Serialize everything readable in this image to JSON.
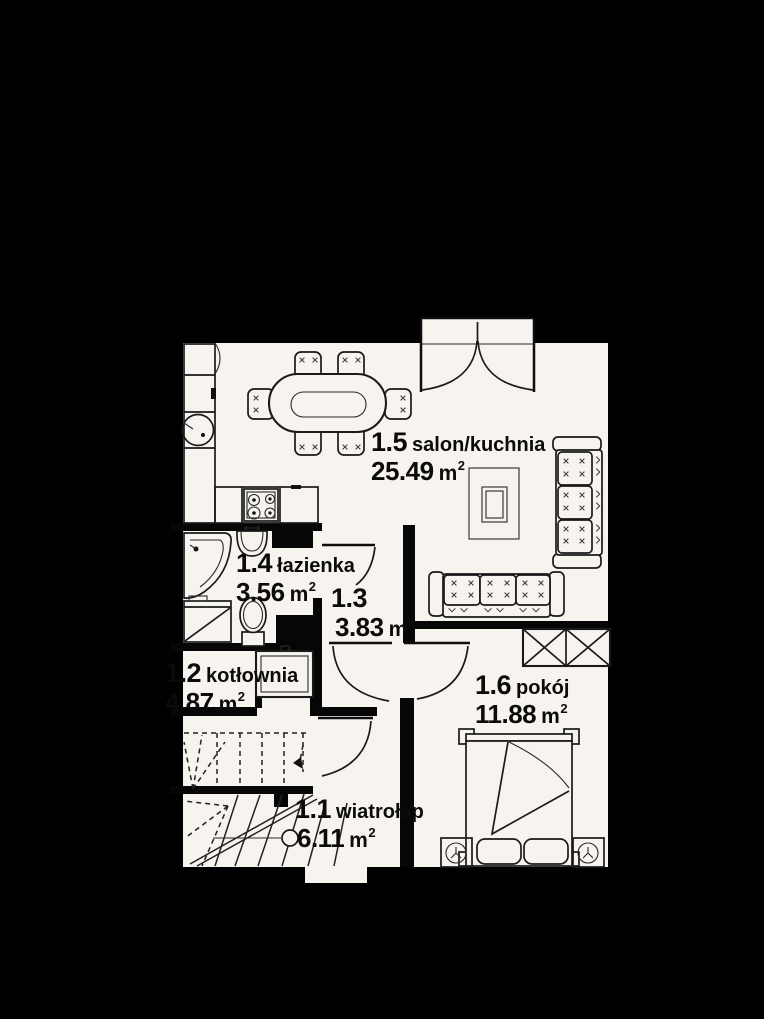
{
  "plan": {
    "type": "architectural-floor-plan",
    "language": "Polish",
    "colors": {
      "background": "#000000",
      "floor": "#f7f3ee",
      "line": "#141414",
      "wall": "#060606",
      "text": "#0b0b0b"
    },
    "rooms": [
      {
        "id": "1.5",
        "name": "salon/kuchnia",
        "area_number": "25.49",
        "area_unit": "m",
        "area_sup": "2"
      },
      {
        "id": "1.4",
        "name": "łazienka",
        "area_number": "3.56",
        "area_unit": "m",
        "area_sup": "2"
      },
      {
        "id": "1.3",
        "name": "",
        "area_number": "3.83",
        "area_unit": "m",
        "area_sup": "2"
      },
      {
        "id": "1.2",
        "name": "kotłownia",
        "area_number": "4.87",
        "area_unit": "m",
        "area_sup": "2"
      },
      {
        "id": "1.6",
        "name": "pokój",
        "area_number": "11.88",
        "area_unit": "m",
        "area_sup": "2"
      },
      {
        "id": "1.1",
        "name": "wiatrołap",
        "area_number": "6.11",
        "area_unit": "m",
        "area_sup": "2"
      }
    ],
    "fixtures": [
      "french-door",
      "interior-door",
      "fridge",
      "kitchen-cabinet",
      "kitchen-sink",
      "countertop",
      "stove",
      "dining-table",
      "chair",
      "corner-bathtub",
      "washbasin",
      "washing-machine",
      "toilet",
      "duct-shaft",
      "boiler",
      "staircase-upper-flight",
      "staircase-lower-flight",
      "walking-line",
      "entrance-step",
      "coffee-table",
      "sofa",
      "wardrobe",
      "double-bed",
      "pillow",
      "nightstand",
      "bedside-lamp"
    ]
  }
}
